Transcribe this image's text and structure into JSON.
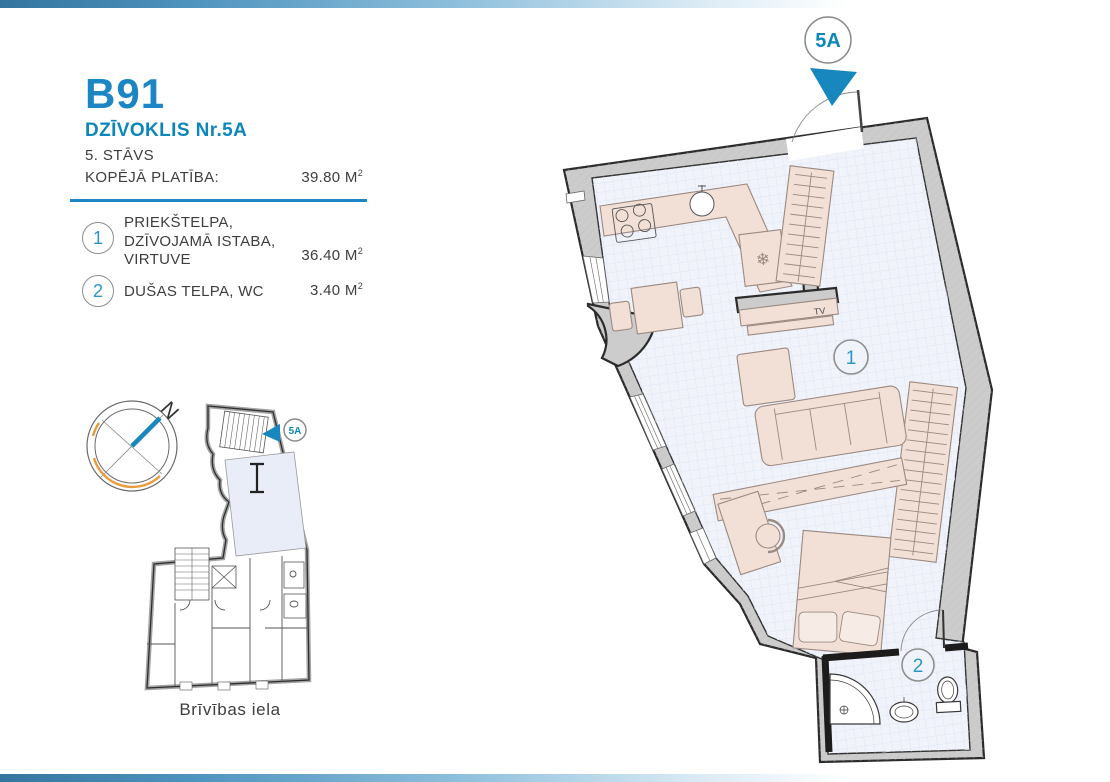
{
  "header": {
    "code": "B91",
    "apartment_label": "DZĪVOKLIS Nr.5A",
    "floor_label": "5. STĀVS",
    "total_area_label": "KOPĒJĀ PLATĪBA:",
    "total_area_value": "39.80",
    "area_unit": "M",
    "area_exp": "2"
  },
  "legend": {
    "item1": {
      "num": "1",
      "line1": "PRIEKŠTELPA,",
      "line2": "DZĪVOJAMĀ ISTABA,",
      "line3": "VIRTUVE",
      "area": "36.40"
    },
    "item2": {
      "num": "2",
      "line1": "DUŠAS TELPA, WC",
      "area": "3.40"
    },
    "area_unit": "M",
    "area_exp": "2"
  },
  "compass": {
    "north_letter": "N"
  },
  "minimap": {
    "street_name": "Brīvības iela",
    "unit_badge": "5A"
  },
  "plan": {
    "entrance_badge": "5A",
    "room1_number": "1",
    "room2_number": "2",
    "tv_label": "TV",
    "fridge_icon": "❄"
  },
  "colors": {
    "accent_blue": "#1c85c4",
    "teal": "#0d87b9",
    "text": "#3e3e3e",
    "wall_fill": "#cccccc",
    "floor_fill": "#f1f3fb",
    "furniture_fill": "#f2dfd6",
    "arrow_teal": "#1787bd",
    "compass_orange": "#ec9a3e"
  }
}
